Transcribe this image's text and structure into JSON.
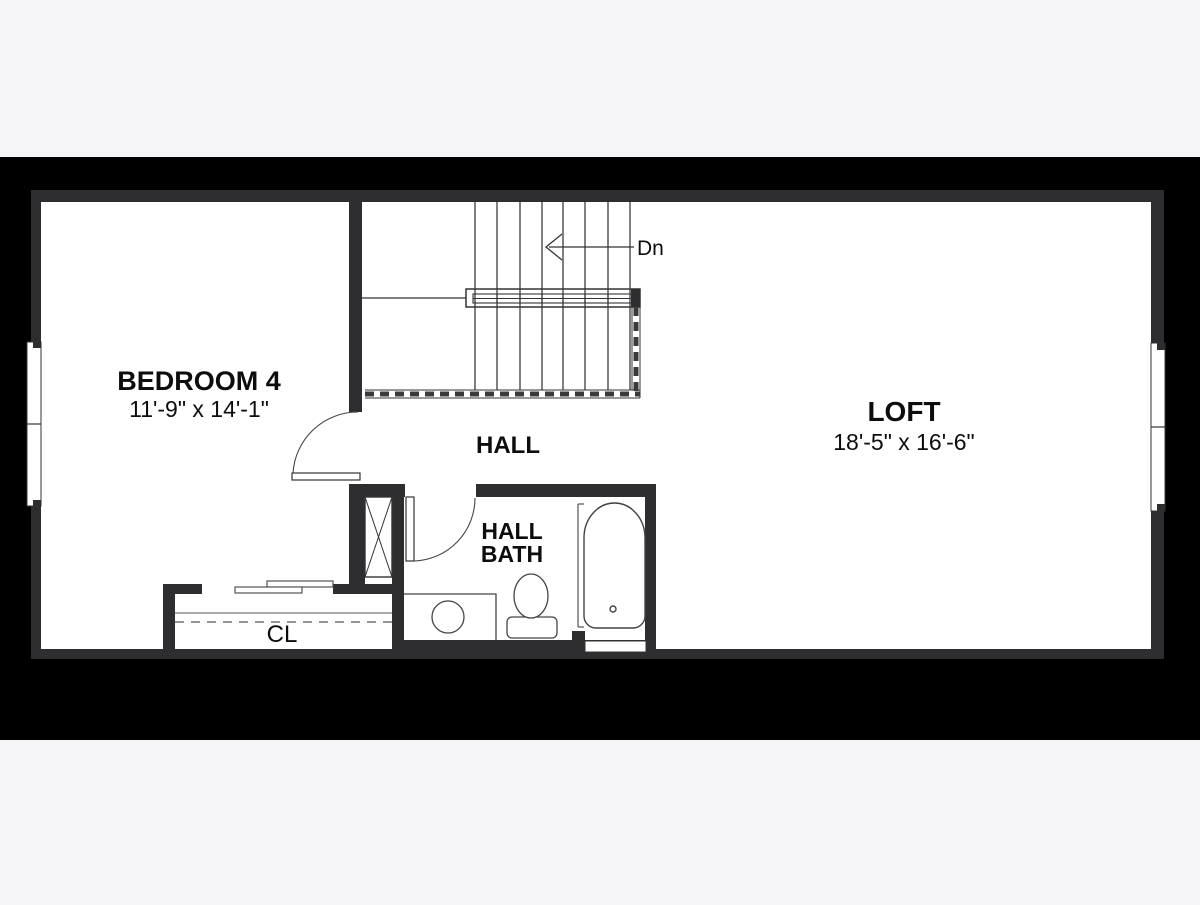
{
  "document": {
    "type": "floor-plan",
    "floor_label": "second floor plan"
  },
  "colors": {
    "page_background": "#f5f4f6",
    "matte_band": "#000000",
    "wall": "#2e2e30",
    "floor": "#ffffff",
    "thin_line": "#3d3d3d"
  },
  "rooms": {
    "bedroom4": {
      "name": "BEDROOM 4",
      "dimensions": "11'-9\" x 14'-1\""
    },
    "loft": {
      "name": "LOFT",
      "dimensions": "18'-5\" x 16'-6\""
    },
    "hall": {
      "name": "HALL"
    },
    "hall_bath": {
      "name_line1": "HALL",
      "name_line2": "BATH"
    },
    "closet": {
      "name": "CL"
    }
  },
  "stairs": {
    "direction_label": "Dn"
  }
}
